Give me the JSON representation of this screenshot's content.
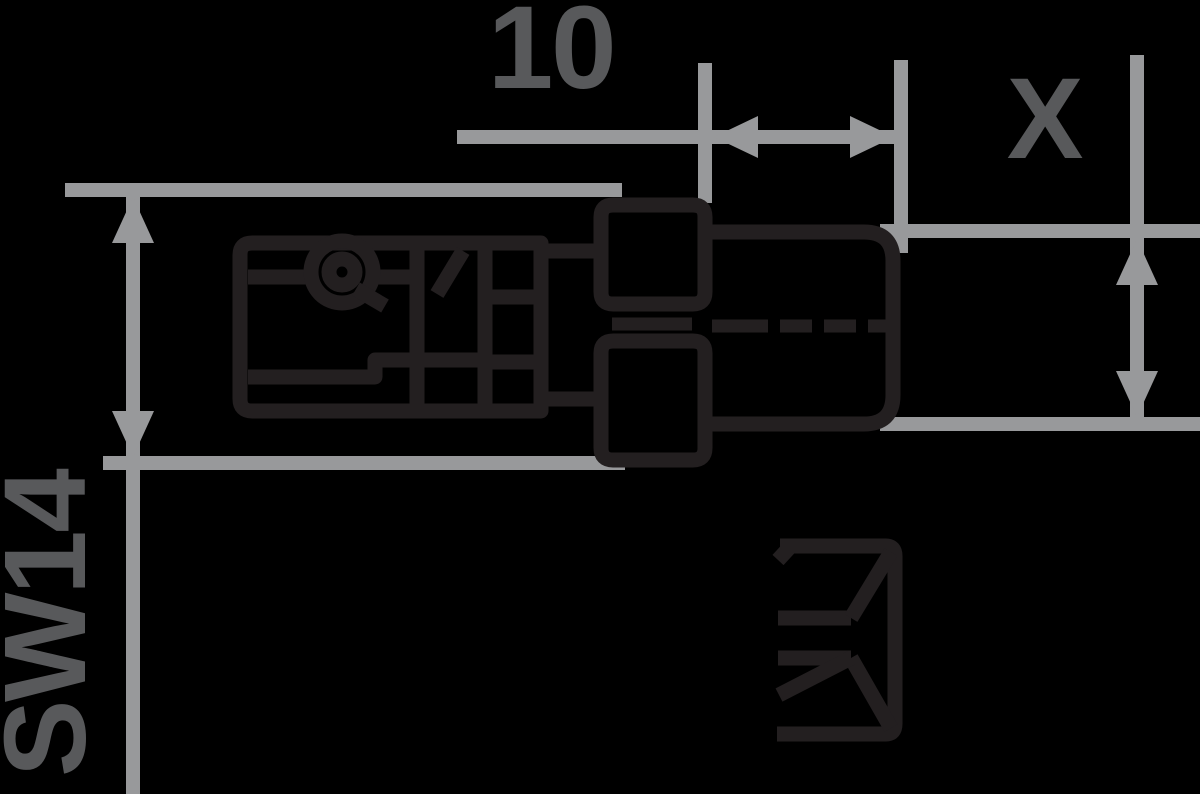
{
  "drawing": {
    "title": "quick-coupling plug side view with dimensions",
    "background_color": "#000000",
    "colors": {
      "part_outline": "#231f20",
      "dimension_lines": "#98999b",
      "dimension_text": "#58595b"
    },
    "dimensions": [
      {
        "id": "thread-length",
        "label": "10",
        "orientation": "horizontal",
        "location": "top"
      },
      {
        "id": "thread-size",
        "label": "X",
        "orientation": "vertical",
        "location": "top-right"
      },
      {
        "id": "hex-across-flats",
        "label": "SW14",
        "orientation": "vertical-rotated",
        "location": "left"
      }
    ],
    "symbols": [
      {
        "id": "coupling-profile-symbol",
        "location": "bottom-right"
      }
    ]
  }
}
